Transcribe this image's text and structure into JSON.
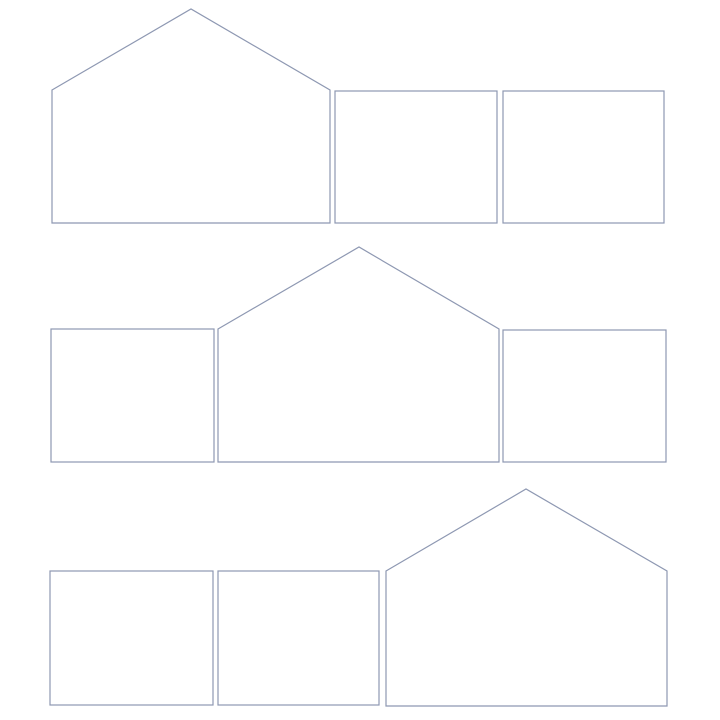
{
  "canvas": {
    "width": 720,
    "height": 720,
    "background": "#ffffff"
  },
  "style": {
    "stroke_color": "#8e98b2",
    "fill_color": "#ffffff",
    "stroke_width": 1.2
  },
  "shapes": [
    {
      "name": "row1-house-shape",
      "kind": "house",
      "points": "52,90 191,9 330,90 330,223 52,223"
    },
    {
      "name": "row1-rectangle-shape-1",
      "kind": "rect",
      "x": 335,
      "y": 91,
      "w": 162,
      "h": 132
    },
    {
      "name": "row1-rectangle-shape-2",
      "kind": "rect",
      "x": 503,
      "y": 91,
      "w": 161,
      "h": 132
    },
    {
      "name": "row2-rectangle-shape-1",
      "kind": "rect",
      "x": 51,
      "y": 329,
      "w": 163,
      "h": 133
    },
    {
      "name": "row2-house-shape",
      "kind": "house",
      "points": "218,329 359,247 499,329 499,462 218,462"
    },
    {
      "name": "row2-rectangle-shape-2",
      "kind": "rect",
      "x": 503,
      "y": 330,
      "w": 163,
      "h": 132
    },
    {
      "name": "row3-rectangle-shape-1",
      "kind": "rect",
      "x": 50,
      "y": 571,
      "w": 163,
      "h": 134
    },
    {
      "name": "row3-rectangle-shape-2",
      "kind": "rect",
      "x": 218,
      "y": 571,
      "w": 161,
      "h": 134
    },
    {
      "name": "row3-house-shape",
      "kind": "house",
      "points": "386,571 526,489 667,571 667,706 386,706"
    }
  ]
}
